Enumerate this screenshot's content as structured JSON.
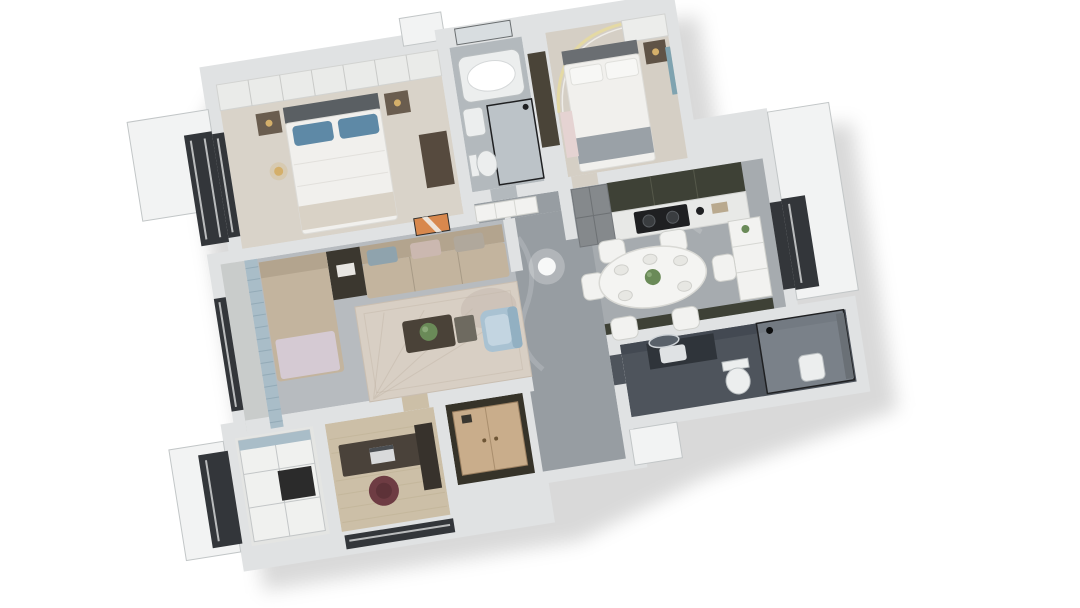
{
  "scene": {
    "description": "3D rendered top-down floor plan of a three-bedroom apartment, rotated about nine degrees, white background",
    "rotation_deg": -9,
    "rooms": [
      "master-bedroom",
      "ensuite-bathroom",
      "bedroom-2",
      "kitchen",
      "dining-area",
      "hallway",
      "living-room",
      "balcony",
      "study",
      "study-closet",
      "entry-hall",
      "dark-bathroom"
    ],
    "furniture": [
      "master-bed",
      "wardrobe",
      "nightstands",
      "bathtub",
      "glass-shower",
      "second-bed",
      "led-ceiling-arc",
      "fridge",
      "cooktop",
      "dining-table",
      "dining-chairs",
      "l-shaped-sofa",
      "coffee-table",
      "blue-armchair",
      "area-rug",
      "orange-wall-art",
      "curtains",
      "desk",
      "maroon-office-chair",
      "closet-shelves",
      "shoe-cabinet",
      "vanity-round-mirror",
      "toilet",
      "shower-enclosure"
    ]
  },
  "colors": {
    "background": "#ffffff",
    "wall_top": "#e0e2e3",
    "wall_edge": "#c2c6c7",
    "ext_white": "#f2f3f3",
    "window_dark": "#33363a",
    "slit_white": "#e8e9e9",
    "floor_cream": "#d9d3c9",
    "floor_cream2": "#d5cfc5",
    "floor_bath": "#b3b9bd",
    "marble": "#a6abaf",
    "marble_light": "#b7bbbf",
    "marble_dark": "#979da2",
    "wood": "#ccbfa7",
    "wood_line": "#bdb093",
    "white_furn": "#f2f2f0",
    "furn_stroke": "#cfd0cc",
    "fixture": "#eceeee",
    "black": "#1f2022",
    "glass": "rgba(205,216,222,0.35)",
    "balcony_floor": "#c9cccb",
    "closet_floor": "#e4e5e3",
    "bath2_floor": "#4e545c",
    "bath2_wall": "#434952",
    "cabinet_dark": "#3e4136",
    "counter": "#e8e9e7",
    "fridge": "#85898c",
    "headboard": "#5a5f63",
    "headboard2": "#6a6e72",
    "pillow_blue": "#5e89a6",
    "bed_white": "#f1f0ed",
    "throw_grey": "#9aa1a7",
    "throw_beige": "#d9d2c6",
    "nightstand": "#6a5d4f",
    "dresser": "#564a3e",
    "lamp_gold": "#d4af6a",
    "led_strip": "#e6d9a0",
    "pink_shelf": "#e5d3d2",
    "teal_curtain": "#7fa3b0",
    "sofa_back": "#b3a48e",
    "sofa_seat": "#c3b49e",
    "chaise_throw": "#d5cad3",
    "table_dark": "#3b372f",
    "coffee_table": "#4a4238",
    "rug": "#d8cfc4",
    "rug_line": "#b9ad9f",
    "chair_blue": "#a9c2d2",
    "chair_blue_dark": "#92b0c2",
    "art_orange": "#d8884d",
    "curtain": "#a9bdc8",
    "curtain_line": "#8aa2af",
    "desk": "#4a423a",
    "chair_maroon": "#6e3c43",
    "entry_wall": "#363329",
    "entry_cabinet": "#c9ad8b",
    "plant_green": "#6a8a58",
    "shadow": "rgba(26,26,26,0.15)"
  }
}
